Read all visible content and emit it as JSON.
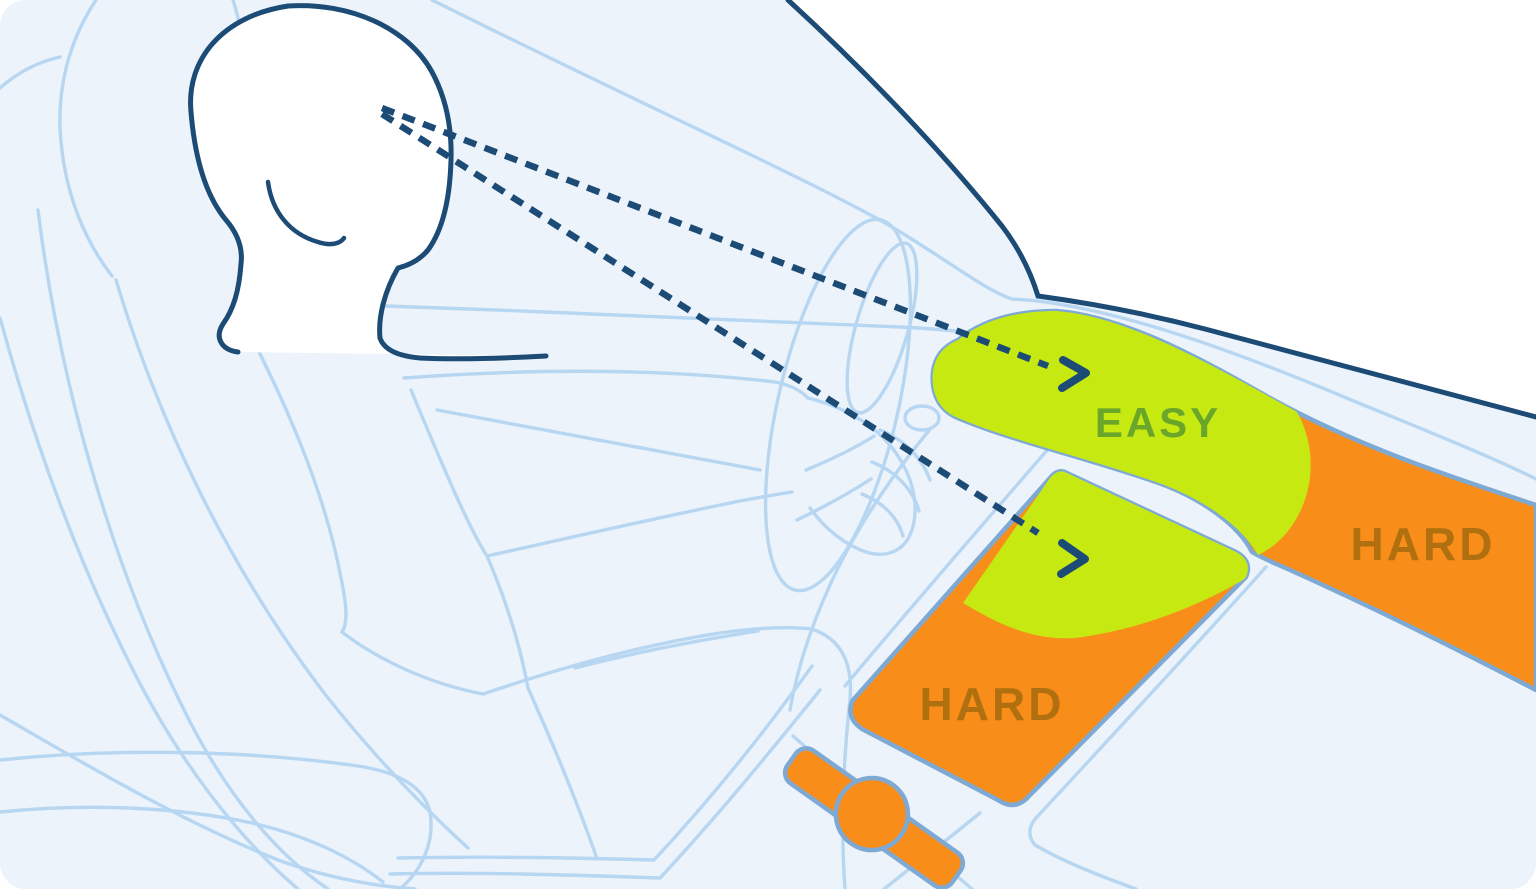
{
  "illustration": {
    "name": "car-cockpit-reach-zones",
    "description": "Side view of a seated driver with dashed gaze lines pointing at the dashboard and the center touchscreen; green areas are easy to see and reach, orange areas are hard"
  },
  "zones": {
    "dashboard": {
      "easy_label": "EASY",
      "hard_label": "HARD"
    },
    "touchscreen": {
      "hard_label": "HARD"
    }
  },
  "colors": {
    "background": "#ecf3fb",
    "cabin_line": "#b7d6f2",
    "navy": "#1c4b76",
    "zone_easy": "#c6ea11",
    "zone_hard": "#f88d1a",
    "easy_text": "#69a62a",
    "hard_text": "#b0700f",
    "panel_stroke": "#7ea9d4",
    "windshield": "#ffffff"
  }
}
